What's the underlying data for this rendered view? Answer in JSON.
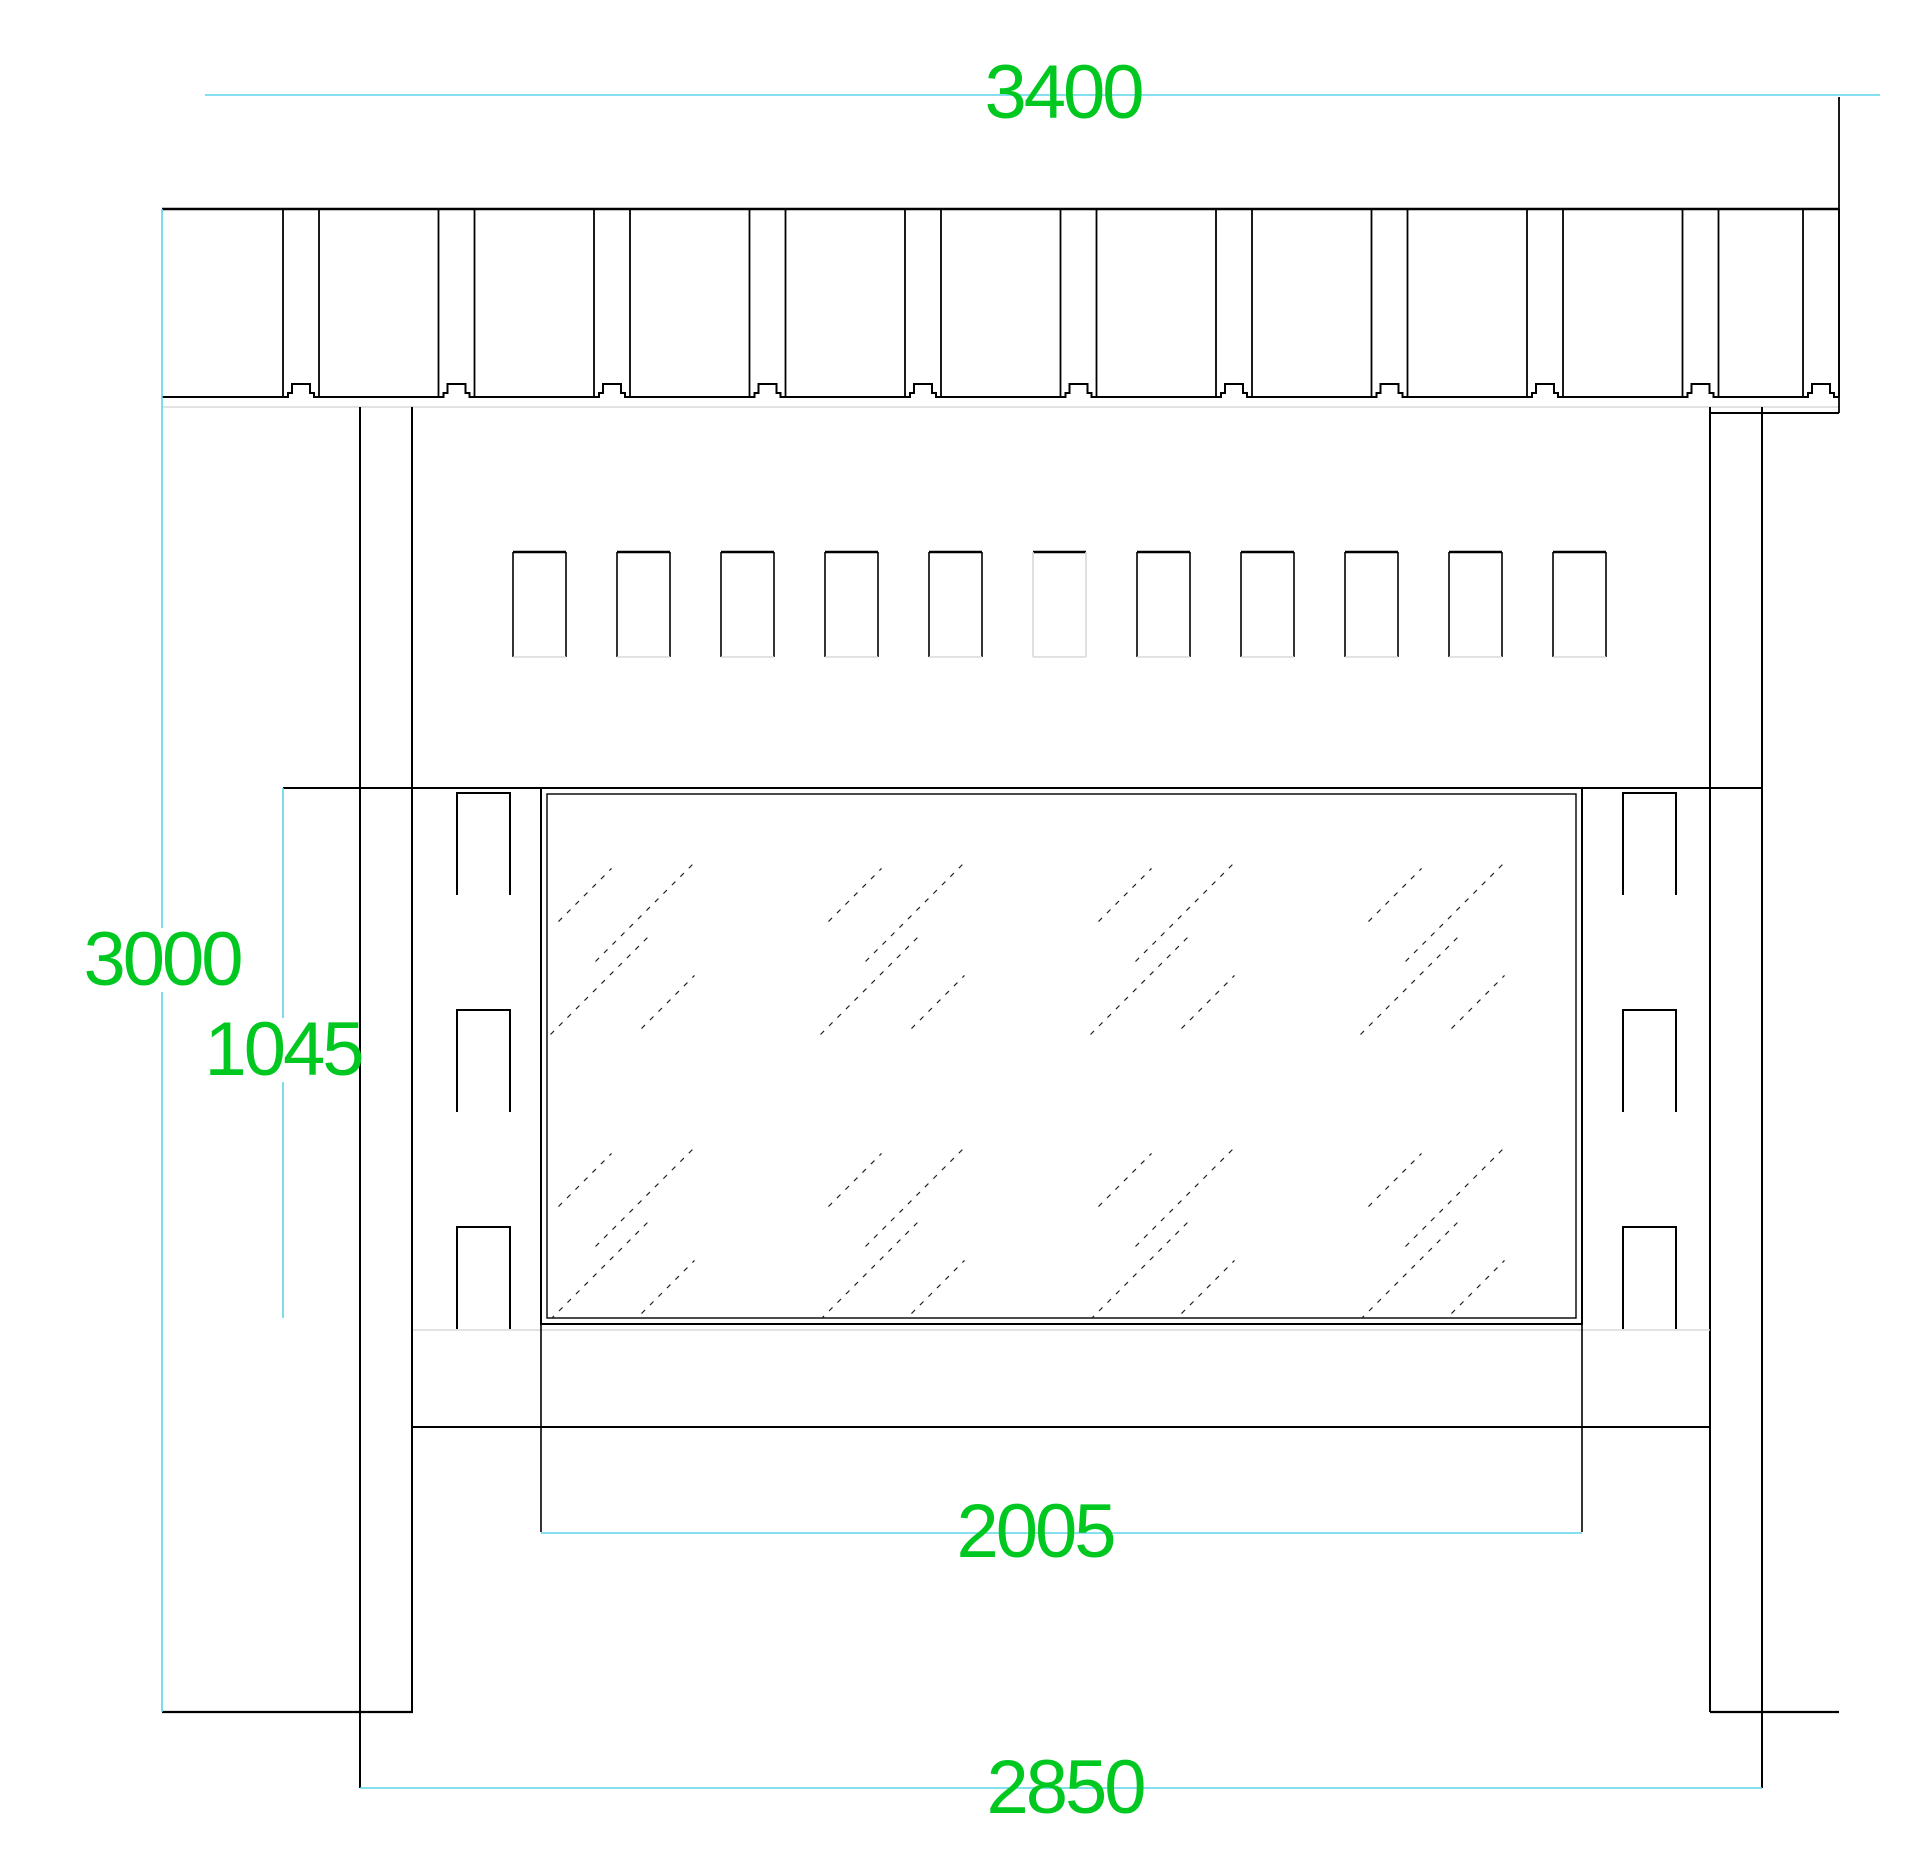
{
  "document_type": "cad-elevation-drawing",
  "colors": {
    "background": "#ffffff",
    "line": "#000000",
    "light_line": "#d8d8d8",
    "hatch_line": "#222222",
    "dimension_line": "#5bd6e8",
    "dimension_text": "#00c820"
  },
  "dimensions": [
    {
      "id": "overall-width",
      "label": "3400",
      "x": 1063,
      "y": 93
    },
    {
      "id": "overall-height",
      "label": "3000",
      "x": 162,
      "y": 960
    },
    {
      "id": "panel-height",
      "label": "1045",
      "x": 283,
      "y": 1050
    },
    {
      "id": "glass-width",
      "label": "2005",
      "x": 1035,
      "y": 1532
    },
    {
      "id": "post-spacing",
      "label": "2850",
      "x": 1065,
      "y": 1788
    }
  ],
  "drawing": {
    "canvas": {
      "width": 1920,
      "height": 1873
    },
    "band": {
      "x1": 162,
      "x2": 1839,
      "top": 209,
      "bottom": 397,
      "light_line_y": 407,
      "pairs": [
        [
          283,
          319
        ],
        [
          438.5,
          474.5
        ],
        [
          594,
          630
        ],
        [
          749.5,
          785.5
        ],
        [
          905,
          941
        ],
        [
          1060.5,
          1096.5
        ],
        [
          1216,
          1252
        ],
        [
          1371.5,
          1407.5
        ],
        [
          1527,
          1563
        ],
        [
          1682.5,
          1718.5
        ],
        [
          1803,
          1839
        ]
      ],
      "seam_bump": {
        "half_width": 13,
        "top_half_width": 9,
        "ledge_height": 4,
        "height": 13
      },
      "right_stub": [
        1710,
        413,
        1839,
        413
      ]
    },
    "ext_lines_black": [
      [
        1839,
        97,
        1839,
        413
      ]
    ],
    "vents": {
      "y": 552,
      "height": 105,
      "width": 53,
      "xs": [
        513,
        617,
        721,
        825,
        929,
        1033,
        1137,
        1241,
        1345,
        1449,
        1553
      ],
      "faint_index": 5
    },
    "posts": {
      "left": {
        "x1": 360,
        "x2": 412
      },
      "right": {
        "x1": 1710,
        "x2": 1762
      },
      "top": 407,
      "bottom": 1712,
      "ext_bottom": 1788
    },
    "mid_top_line": {
      "y": 788,
      "x1": 283,
      "x2": 1762
    },
    "glass": {
      "outer": [
        541,
        788,
        1582,
        1324
      ],
      "inner": [
        547,
        794,
        1576,
        1318
      ]
    },
    "flank_rects": {
      "width": 53,
      "height": 102,
      "left_x": 457,
      "right_x": 1623,
      "row_ys": [
        793,
        1010,
        1227
      ]
    },
    "light_lines": [
      [
        413,
        1330,
        1710,
        1330
      ]
    ],
    "shelf_line": {
      "y": 1427,
      "x1": 413,
      "x2": 1710
    },
    "footer_lines": [
      [
        162,
        1712,
        413,
        1712
      ],
      [
        1710,
        1712,
        1839,
        1712
      ]
    ],
    "glass_ext_lines": [
      [
        541,
        1324,
        541,
        1532
      ],
      [
        1582,
        1324,
        1582,
        1532
      ]
    ],
    "cyan_lines": [
      [
        205,
        95,
        1880,
        95
      ],
      [
        162,
        209,
        162,
        928
      ],
      [
        162,
        992,
        162,
        1712
      ],
      [
        283,
        788,
        283,
        1018
      ],
      [
        283,
        1082,
        283,
        1318
      ],
      [
        541,
        1533,
        1582,
        1533
      ],
      [
        360,
        1788,
        1762,
        1788
      ]
    ],
    "hatch": {
      "columns": [
        640,
        910,
        1180,
        1450
      ],
      "rows": [
        940,
        1225
      ],
      "strokes": [
        {
          "dx": -55,
          "dy": -45,
          "len": 75
        },
        {
          "dx": 5,
          "dy": -28,
          "len": 140
        },
        {
          "dx": -40,
          "dy": 45,
          "len": 140
        },
        {
          "dx": 28,
          "dy": 62,
          "len": 75
        }
      ],
      "dash": "5 7"
    }
  }
}
